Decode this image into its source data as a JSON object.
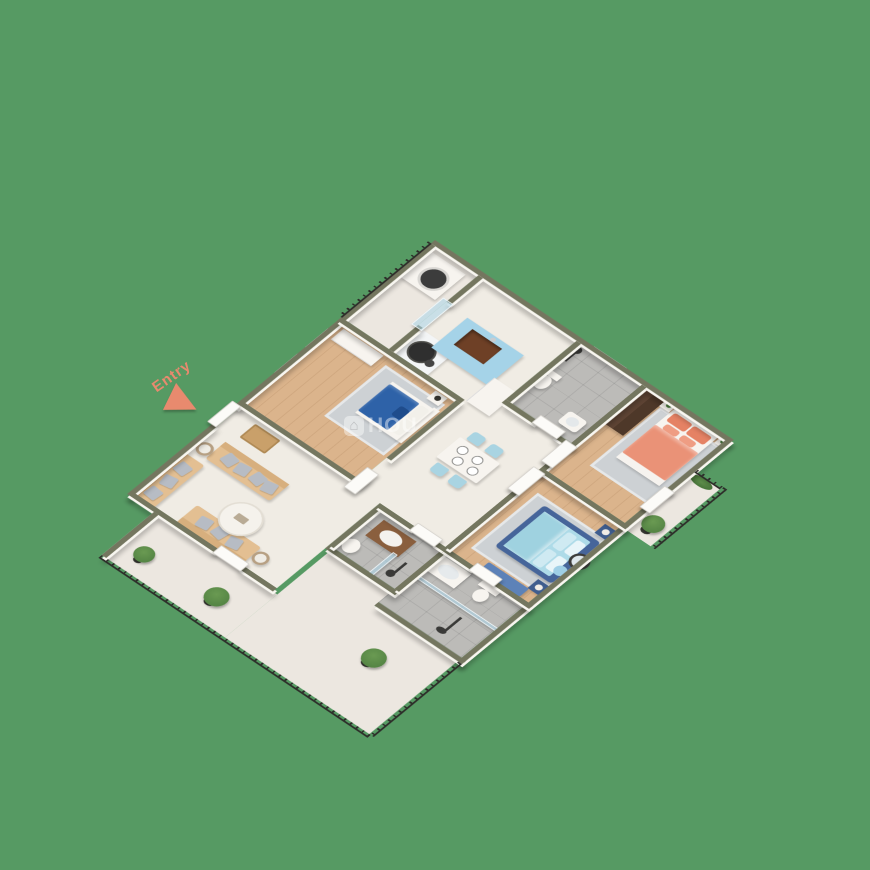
{
  "entry": {
    "label": "Entry"
  },
  "watermark": {
    "icon": "house-icon",
    "text": "HOU"
  },
  "colors": {
    "background": "#569a63",
    "wall_top": "#74765f",
    "wall_face": "#f8f6f0",
    "wood_floor": "#dbb48c",
    "marble_floor": "#f0ece4",
    "tile_floor": "#bcbbb8",
    "balcony_floor": "#ece7e0",
    "door_white": "#fcfbf8",
    "coral_bed": "#ea9277",
    "coral_pillow": "#e58264",
    "master_bedding": "#aedbe8",
    "bed_frame_navy": "#46659a",
    "duvet_blue": "#2e62a8",
    "sofa_tan": "#e3bf92",
    "sofa_back_tan": "#d7af7e",
    "cushion_gray": "#b7bcc4",
    "chair_blue": "#a9d4e2",
    "island_blue": "#a5d3e8",
    "sink_brown": "#6e4026",
    "wardrobe_brown": "#5e4434",
    "vanity_wood": "#8a5f3e",
    "railing_black": "#2c2b28",
    "plant_green": "#4c7c3f",
    "rug_gray": "#cdd1d4",
    "bench_blue": "#5d82b8",
    "entry_coral": "#e88a6e",
    "tv_black": "#2b2b2b"
  }
}
